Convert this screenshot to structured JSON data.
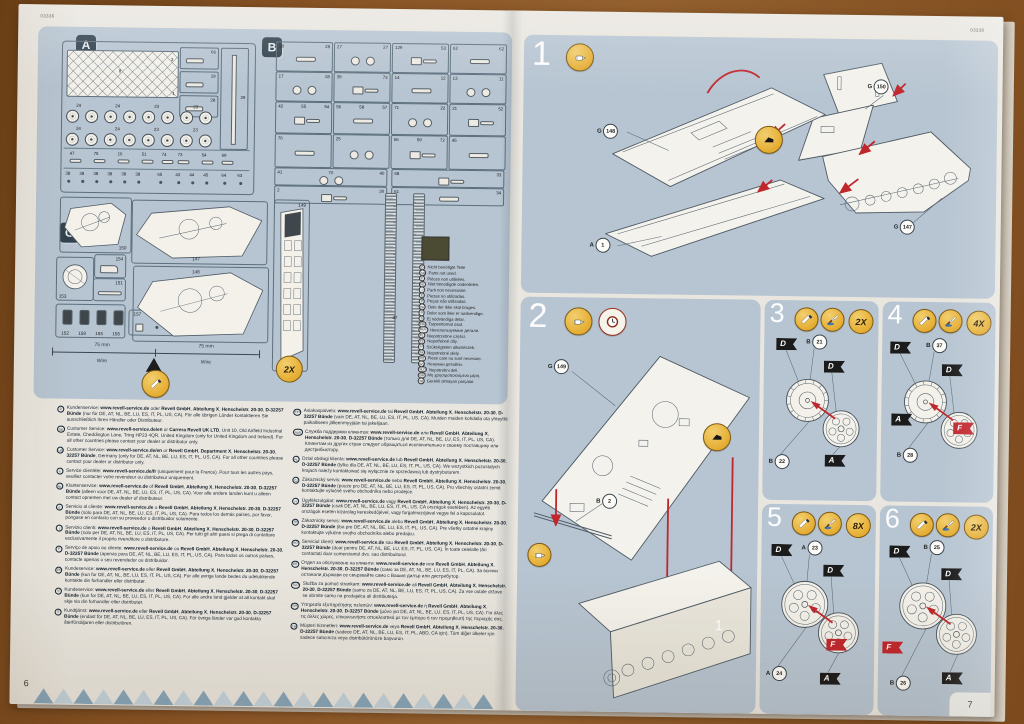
{
  "colors": {
    "blue": "#b7c5d2",
    "paper": "#e9e6df",
    "red": "#c0272d",
    "yellow": "#e7b23a",
    "swatch": "#4b4a33"
  },
  "left_page": {
    "code": "03336",
    "page_number": "6",
    "panel_a": {
      "label": "A",
      "net_numbers": [
        "8",
        "3",
        "1"
      ],
      "side_boxes": [
        "66",
        "19",
        "28"
      ],
      "tall_box": "29",
      "wheel_labels": [
        "24",
        "24",
        "23",
        "23"
      ],
      "small_row1": [
        "47",
        "75",
        "16",
        "51",
        "74",
        "73",
        "54",
        "69"
      ],
      "small_row2": [
        "38",
        "38",
        "38",
        "38",
        "38",
        "38",
        "65",
        "43",
        "44",
        "45",
        "64",
        "63"
      ]
    },
    "panel_b": {
      "label": "B",
      "rows": [
        [
          [
            "28",
            "28"
          ],
          [
            "27",
            "27"
          ],
          [
            "129",
            "53"
          ],
          [
            "62",
            "62"
          ]
        ],
        [
          [
            "17",
            "18"
          ],
          [
            "39",
            "73"
          ],
          [
            "14",
            "12"
          ],
          [
            "13",
            "11"
          ]
        ],
        [
          [
            "42",
            "55",
            "54"
          ],
          [
            "56",
            "58",
            "57"
          ],
          [
            "71",
            "22"
          ],
          [
            "21",
            "52"
          ]
        ],
        [
          [
            "76"
          ],
          [
            "25"
          ],
          [
            "66",
            "59",
            "72"
          ],
          [
            "45"
          ]
        ],
        [
          [
            "41",
            "70",
            "40"
          ],
          [
            "68",
            "33"
          ]
        ],
        [
          [
            "2",
            "30"
          ],
          [
            "61",
            "34"
          ]
        ]
      ]
    },
    "panel_g": {
      "label": "G",
      "n150": "150",
      "n154": "154",
      "n153": "153",
      "n151": "151",
      "figs": [
        "152",
        "158",
        "155",
        "156"
      ],
      "clip": [
        "157",
        "38"
      ],
      "n147": "147",
      "n148": "148",
      "n149": "149",
      "track_number": "37"
    },
    "ruler": {
      "len_left": "75 mm",
      "len_right": "75 mm",
      "wire_left": "Wire",
      "wire_right": "Wire",
      "badge": "2X"
    },
    "legend": {
      "items": [
        {
          "code": "D",
          "text": "Nicht benötigte Teile"
        },
        {
          "code": "GB",
          "text": "Parts not used."
        },
        {
          "code": "F",
          "text": "Pièces non utilisées."
        },
        {
          "code": "NL",
          "text": "Niet benodigde onderdelen."
        },
        {
          "code": "I",
          "text": "Parti non necessarie."
        },
        {
          "code": "E",
          "text": "Piezas no utilizadas."
        },
        {
          "code": "P",
          "text": "Peças não utilizadas."
        },
        {
          "code": "DK",
          "text": "Dele der ikke skal bruges."
        },
        {
          "code": "N",
          "text": "Deler som ikke er nødvendige."
        },
        {
          "code": "S",
          "text": "Ej nödvändiga delar."
        },
        {
          "code": "FIN",
          "text": "Tarpeettomat osat."
        },
        {
          "code": "RUS",
          "text": "Неиспользуемые детали."
        },
        {
          "code": "PL",
          "text": "Niepotrzebne części."
        },
        {
          "code": "CZ",
          "text": "Nepotřebné díly."
        },
        {
          "code": "H",
          "text": "Szükségtelen alkatrészek."
        },
        {
          "code": "SK",
          "text": "Nepotrebné diely."
        },
        {
          "code": "RO",
          "text": "Piese care nu sunt necesare."
        },
        {
          "code": "BG",
          "text": "Ненужни детайли."
        },
        {
          "code": "SLO",
          "text": "Nepotrebni deli."
        },
        {
          "code": "GR",
          "text": "Μη χρησιμοποιούμενα μέρη."
        },
        {
          "code": "TR",
          "text": "Gerekli olmayan parçalar."
        }
      ]
    },
    "service_left": [
      {
        "code": "D",
        "text": "Kundenservice: www.revell-service.de oder Revell GmbH, Abteilung X, Henschelstr. 20-30, D-32257 Bünde (nur für DE, AT, NL, BE, LU, ES, IT, PL, US, CA). Für alle übrigen Länder kontaktieren Sie ausschließlich Ihren Händler oder Distributeur."
      },
      {
        "code": "GB",
        "text": "Customer Service: www.revell-service.de/en or Carrera Revell UK LTD, Unit 10, Old Airfield Industrial Estate, Cheddington Lane, Tring HP23 4QR, United Kingdom (only for United Kingdom and Ireland). For all other countries please contact your dealer or distributor only."
      },
      {
        "code": "US",
        "text": "Customer Service: www.revell-service.de/en or Revell GmbH, Department X, Henschelstr. 20-30, 32257 Bünde, Germany (only for DE, AT, NL, BE, LU, ES, IT, PL, US, CA). For all other countries please contact your dealer or distributor only."
      },
      {
        "code": "F",
        "text": "Service clientèle: www.revell-service.de/fr (uniquement pour la France). Pour tous les autres pays, veuillez contacter votre revendeur ou distributeur uniquement."
      },
      {
        "code": "NL",
        "text": "Klantenservice: www.revell-service.de of Revell GmbH, Abteilung X, Henschelstr. 20-30, D-32257 Bünde (alleen voor DE, AT, NL, BE, LU, ES, IT, PL, US, CA). Voor alle andere landen kunt u alleen contact opnemen met uw dealer of distributeur."
      },
      {
        "code": "E",
        "text": "Servicio al cliente: www.revell-service.de o Revell GmbH, Abteilung X, Henschelstr. 20-30, D-32257 Bünde (sólo para DE, AT, NL, BE, LU, ES, IT, PL, US, CA). Para todos los demás países, por favor, póngase en contacto con su proveedor o distribuidor solamente."
      },
      {
        "code": "I",
        "text": "Servizio clienti: www.revell-service.de o Revell GmbH, Abteilung X, Henschelstr. 20-30, D-32257 Bünde (solo per DE, AT, NL, BE, LU, ES, IT, PL, US, CA). Per tutti gli altri paesi si prega di contattare esclusivamente il proprio rivenditore o distributore."
      },
      {
        "code": "P",
        "text": "Serviço de apoio ao cliente: www.revell-service.de ou Revell GmbH, Abteilung X, Henschelstr. 20-30, D-32257 Bünde (apenas para DE, AT, NL, BE, LU, ES, IT, PL, US, CA). Para todos os outros países, contacte apenas o seu revendedor ou distribuidor."
      },
      {
        "code": "DK",
        "text": "Kundeservice: www.revell-service.de eller Revell GmbH, Abteilung X, Henschelstr. 20-30, D-32257 Bünde (kun for DE, AT, NL, BE, LU, ES, IT, PL, US, CA). For alle øvrige lande bedes du udelukkende kontakte din forhandler eller distributør."
      },
      {
        "code": "N",
        "text": "Kundeservice: www.revell-service.de eller Revell GmbH, Abteilung X, Henschelstr. 20-30, D-32257 Bünde (kun for DE, AT, NL, BE, LU, ES, IT, PL, US, CA). For alle andre land gjelder at all kontakt skal skje via din forhandler eller distributør."
      },
      {
        "code": "S",
        "text": "Kundtjänst: www.revell-service.de eller Revell GmbH, Abteilung X, Henschelstr. 20-30, D-32257 Bünde (endast för DE, AT, NL, BE, LU, ES, IT, PL, US, CA). För övriga länder var god kontakta återförsäljaren eller distributören."
      }
    ],
    "service_right": [
      {
        "code": "FIN",
        "text": "Asiakaspalvelu: www.revell-service.de tai Revell GmbH, Abteilung X, Henschelstr. 20-30, D-32257 Bünde (vain DE, AT, NL, BE, LU, ES, IT, PL, US, CA). Muiden maiden kohdalla ota yhteyttä paikalliseen jälleenmyyjään tai jakelijaan."
      },
      {
        "code": "RUS",
        "text": "Служба поддержки клиентов: www.revell-service.de или Revell GmbH, Abteilung X, Henschelstr. 20-30, D-32257 Bünde (только для DE, AT, NL, BE, LU, ES, IT, PL, US, CA). Клиентам из других стран следует обращаться исключительно к своему поставщику или дистрибьютору."
      },
      {
        "code": "PL",
        "text": "Dział obsługi klienta: www.revell-service.de lub Revell GmbH, Abteilung X, Henschelstr. 20-30, D-32257 Bünde (tylko dla DE, AT, NL, BE, LU, ES, IT, PL, US, CA). We wszystkich pozostałych krajach należy kontaktować się wyłącznie ze sprzedawcą lub dystrybutorem."
      },
      {
        "code": "CZ",
        "text": "Zákaznický servis: www.revell-service.de nebo Revell GmbH, Abteilung X, Henschelstr. 20-30, D-32257 Bünde (pouze pro DE, AT, NL, BE, LU, ES, IT, PL, US, CA). Pro všechny ostatní země kontaktujte výlučně svého obchodníka nebo prodejce."
      },
      {
        "code": "H",
        "text": "Ügyfélszolgálat: www.revell-service.de vagy Revell GmbH, Abteilung X, Henschelstr. 20-30, D-32257 Bünde (csak DE, AT, NL, BE, LU, ES, IT, PL, US, CA országok esetében). Az egyéb országok esetén kizárólag kereskedőjével, vagy forgalmazójával vegye fel a kapcsolatot."
      },
      {
        "code": "SK",
        "text": "Zákaznícky servis: www.revell-service.de alebo Revell GmbH, Abteilung X, Henschelstr. 20-30, D-32257 Bünde (iba pre DE, AT, NL, BE, LU, ES, IT, PL, US, CA). Pre všetky ostatné krajiny kontaktujte výlučne svojho obchodníka alebo predajcu."
      },
      {
        "code": "RO",
        "text": "Serviciul clienți: www.revell-service.de sau Revell GmbH, Abteilung X, Henschelstr. 20-30, D-32257 Bünde (doar pentru DE, AT, NL, BE, LU, ES, IT, PL, US, CA). În toate celelalte țări contactați doar comerciantul dvs. sau distribuitorul."
      },
      {
        "code": "BG",
        "text": "Отдел за обслужване на клиенти: www.revell-service.de или Revell GmbH, Abteilung X, Henschelstr. 20-30, D-32257 Bünde (само за DE, AT, NL, BE, LU, ES, IT, PL, CA). За всички останали държави се свързвайте само с Вашия дилър или дистрибутор."
      },
      {
        "code": "SLO",
        "text": "Služba za pomoč strankam: www.revell-service.de ali Revell GmbH, Abteilung X, Henschelstr. 20-30, D-32257 Bünde (samo za DE, AT, NL, BE, LU, ES, IT, PL, US, CA). Za vse ostale države se obrnite samo na prodajalca ali distributerja."
      },
      {
        "code": "GR",
        "text": "Υπηρεσία εξυπηρέτησης πελατών: www.revell-service.de ή Revell GmbH, Abteilung X, Henschelstr. 20-30, D-32257 Bünde (μόνο για DE, AT, NL, BE, LU, ES, IT, PL, US, CA). Για όλες τις άλλες χώρες, επικοινωνήστε αποκλειστικά με τον έμπορο ή τον προμηθευτή της περιοχής σας."
      },
      {
        "code": "TR",
        "text": "Müşteri hizmetleri: www.revell-service.de veya Revell GmbH, Abteilung X, Henschelstr. 20-30, D-32257 Bünde (sadece DE, AT, NL, BE, LU, ES, IT, PL, ABD, CA için). Tüm diğer ülkeler için sadece satıcınıza veya distribütörünüze başvurun."
      }
    ]
  },
  "right_page": {
    "code": "03336",
    "page_number": "7",
    "steps": [
      {
        "num": "1",
        "icons": [
          "cement"
        ],
        "parts": [
          "G 148",
          "G 150",
          "G 147",
          "A 1"
        ]
      },
      {
        "num": "2",
        "icons": [
          "cement",
          "clock"
        ],
        "parts": [
          "G 149",
          "B 2"
        ],
        "callout": "1"
      },
      {
        "num": "3",
        "icons": [
          "knife",
          "paint"
        ],
        "badge": "2X",
        "part_top": "B 21",
        "part_bottom": "B 22",
        "flags": [
          "D",
          "D",
          "A"
        ]
      },
      {
        "num": "4",
        "icons": [
          "knife",
          "paint"
        ],
        "badge": "4X",
        "part_top": "B 37",
        "part_bottom": "B 28",
        "flags": [
          "D",
          "D",
          "A",
          "F"
        ]
      },
      {
        "num": "5",
        "icons": [
          "knife",
          "paint"
        ],
        "badge": "8X",
        "part_top": "A 23",
        "part_bottom": "A 24",
        "flags": [
          "D",
          "D",
          "F",
          "A"
        ]
      },
      {
        "num": "6",
        "icons": [
          "knife",
          "paint"
        ],
        "badge": "2X",
        "part_top": "B 25",
        "part_bottom": "B 26",
        "flags": [
          "D",
          "D",
          "F",
          "A"
        ]
      }
    ]
  }
}
